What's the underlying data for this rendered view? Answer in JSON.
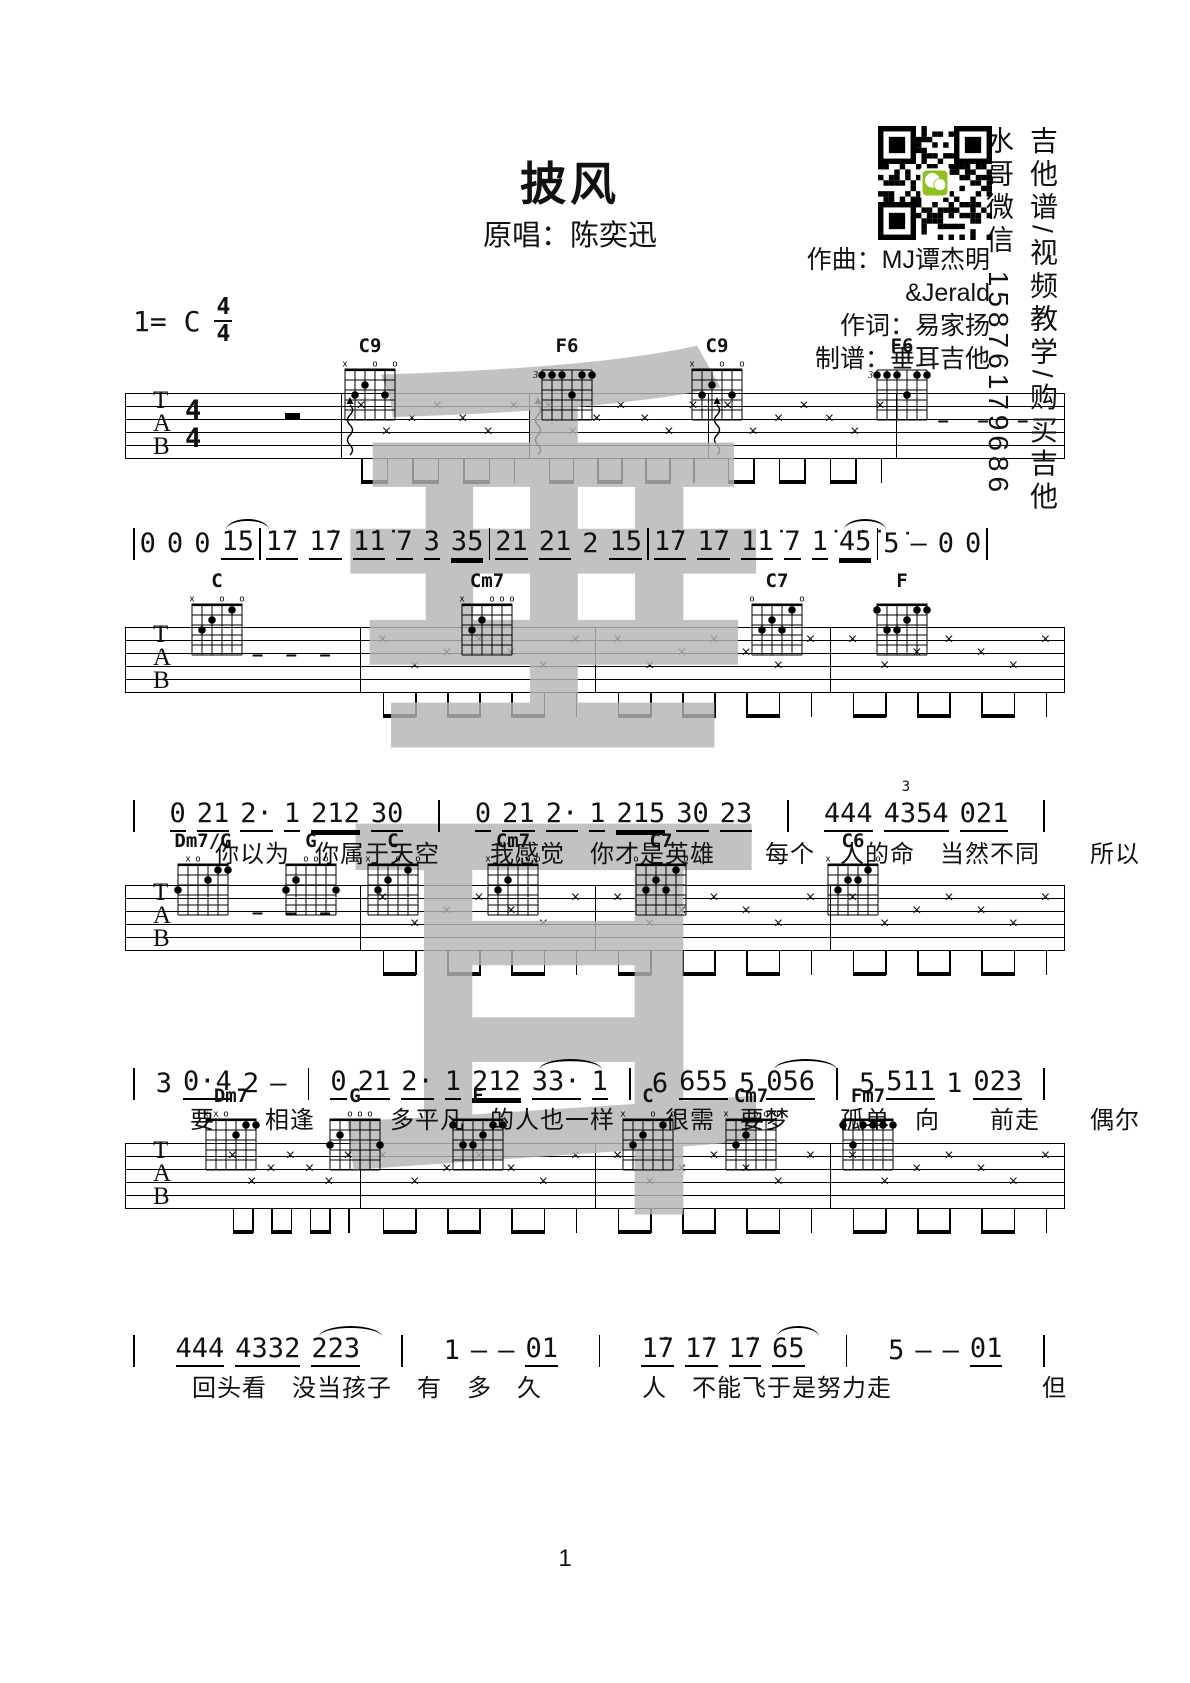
{
  "header": {
    "title": "披风",
    "subtitle": "原唱：陈奕迅",
    "credits": [
      "作曲：MJ谭杰明",
      "&Jerald",
      "作词：易家扬",
      "制谱：垂耳吉他"
    ],
    "side_text_1": "吉他谱/视频教学/购买吉他",
    "side_text_2": "水哥微信 15876179686",
    "key_label": "1= C",
    "time_signature": {
      "top": "4",
      "bottom": "4"
    }
  },
  "watermark": {
    "chars": [
      "垂",
      "耳"
    ],
    "color": "#b5b5b5"
  },
  "page": {
    "number": "1"
  },
  "staff_labels": [
    "T",
    "A",
    "B"
  ],
  "chord_shapes": {
    "C9": {
      "marks": [
        "x",
        "",
        "",
        "o",
        "",
        "o"
      ],
      "dots": [
        [
          5,
          3
        ],
        [
          4,
          2
        ],
        [
          2,
          3
        ]
      ]
    },
    "F6": {
      "base": "3",
      "dots": [
        [
          6,
          1
        ],
        [
          5,
          1
        ],
        [
          4,
          1
        ],
        [
          2,
          1
        ],
        [
          1,
          1
        ],
        [
          3,
          3
        ]
      ]
    },
    "C": {
      "marks": [
        "x",
        "",
        "",
        "o",
        "",
        "o"
      ],
      "dots": [
        [
          5,
          3
        ],
        [
          4,
          2
        ],
        [
          2,
          1
        ]
      ]
    },
    "Cm7": {
      "marks": [
        "x",
        "",
        "",
        "o",
        "o",
        "o"
      ],
      "dots": [
        [
          5,
          3
        ],
        [
          4,
          2
        ]
      ]
    },
    "C7": {
      "marks": [
        "o",
        "",
        "",
        "",
        "",
        "o"
      ],
      "dots": [
        [
          5,
          3
        ],
        [
          4,
          2
        ],
        [
          3,
          3
        ],
        [
          2,
          1
        ]
      ]
    },
    "F": {
      "marks": [
        "",
        "",
        "",
        "",
        "",
        ""
      ],
      "dots": [
        [
          6,
          1
        ],
        [
          2,
          1
        ],
        [
          1,
          1
        ],
        [
          3,
          2
        ],
        [
          5,
          3
        ],
        [
          4,
          3
        ]
      ]
    },
    "Dm7/G": {
      "marks": [
        "",
        "x",
        "o",
        "",
        "",
        ""
      ],
      "dots": [
        [
          6,
          3
        ],
        [
          3,
          2
        ],
        [
          2,
          1
        ],
        [
          1,
          1
        ]
      ]
    },
    "G": {
      "marks": [
        "",
        "",
        "o",
        "o",
        "o",
        ""
      ],
      "dots": [
        [
          6,
          3
        ],
        [
          5,
          2
        ],
        [
          1,
          3
        ]
      ]
    },
    "C6": {
      "marks": [
        "x",
        "",
        "",
        "",
        "",
        "o"
      ],
      "dots": [
        [
          5,
          3
        ],
        [
          4,
          2
        ],
        [
          3,
          2
        ],
        [
          2,
          1
        ]
      ]
    },
    "Dm7": {
      "marks": [
        "x",
        "x",
        "o",
        "",
        "",
        ""
      ],
      "dots": [
        [
          3,
          2
        ],
        [
          2,
          1
        ],
        [
          1,
          1
        ]
      ]
    },
    "Fm7": {
      "marks": [
        "",
        "",
        "",
        "",
        "",
        ""
      ],
      "dots": [
        [
          6,
          1
        ],
        [
          5,
          3
        ],
        [
          4,
          1
        ],
        [
          3,
          1
        ],
        [
          2,
          1
        ],
        [
          1,
          1
        ]
      ]
    }
  },
  "systems": [
    {
      "chordY": 336,
      "chords": [
        {
          "name": "C9",
          "left": 335
        },
        {
          "name": "F6",
          "left": 532
        },
        {
          "name": "C9",
          "left": 682
        },
        {
          "name": "F6",
          "left": 867
        }
      ],
      "staff": {
        "top": 393,
        "left": 125,
        "width": 940,
        "timesig": true,
        "measures": [
          {
            "end": 0.23,
            "type": "rest"
          },
          {
            "end": 0.43,
            "type": "x",
            "arp": true
          },
          {
            "end": 0.62,
            "type": "x",
            "arp": true
          },
          {
            "end": 0.82,
            "type": "x",
            "arp": true
          },
          {
            "end": 1,
            "type": "dash"
          }
        ]
      },
      "melody": {
        "top": 528,
        "left": 133,
        "width": 855,
        "measures": [
          [
            {
              "t": "0"
            },
            {
              "t": "0"
            },
            {
              "t": "0"
            },
            {
              "t": "15",
              "u": 1,
              "tie": true
            }
          ],
          [
            {
              "t": "1̇7",
              "u": 1
            },
            {
              "t": "1̇7",
              "u": 1
            },
            {
              "t": "1̇1̇",
              "u": 1
            },
            {
              "t": "7",
              "u": 1
            },
            {
              "t": "3",
              "u": 1
            },
            {
              "t": "35",
              "u": 2
            }
          ],
          [
            {
              "t": "21",
              "u": 1
            },
            {
              "t": "21",
              "u": 1
            },
            {
              "t": "2"
            },
            {
              "t": "15",
              "u": 1
            }
          ],
          [
            {
              "t": "1̇7",
              "u": 1
            },
            {
              "t": "1̇7",
              "u": 1
            },
            {
              "t": "1̇1̇",
              "u": 1
            },
            {
              "t": "7",
              "u": 1
            },
            {
              "t": "1̇",
              "u": 1
            },
            {
              "t": "4̇5̇",
              "u": 2,
              "tie": true
            }
          ],
          [
            {
              "t": "5̇"
            },
            {
              "t": "—"
            },
            {
              "t": "0"
            },
            {
              "t": "0"
            }
          ]
        ]
      },
      "lyrics": null
    },
    {
      "chordY": 571,
      "chords": [
        {
          "name": "C",
          "left": 182
        },
        {
          "name": "Cm7",
          "left": 452
        },
        {
          "name": "C7",
          "left": 742
        },
        {
          "name": "F",
          "left": 867
        }
      ],
      "staff": {
        "top": 627,
        "left": 125,
        "width": 940,
        "timesig": false,
        "measures": [
          {
            "end": 0.25,
            "type": "dash"
          },
          {
            "end": 0.5,
            "type": "x"
          },
          {
            "end": 0.75,
            "type": "x"
          },
          {
            "end": 1,
            "type": "x"
          }
        ]
      },
      "melody": {
        "top": 800,
        "left": 133,
        "width": 912,
        "measures": [
          [
            {
              "t": "0",
              "u": 1
            },
            {
              "t": "21",
              "u": 1
            },
            {
              "t": "2·",
              "u": 1
            },
            {
              "t": "1",
              "u": 1
            },
            {
              "t": "212",
              "u": 2
            },
            {
              "t": "30",
              "u": 1
            }
          ],
          [
            {
              "t": "0",
              "u": 1
            },
            {
              "t": "21",
              "u": 1
            },
            {
              "t": "2·",
              "u": 1
            },
            {
              "t": "1",
              "u": 1
            },
            {
              "t": "215",
              "u": 2
            },
            {
              "t": "30",
              "u": 1
            },
            {
              "t": "23",
              "u": 1
            }
          ],
          [
            {
              "t": "444",
              "u": 1
            },
            {
              "t": "4354",
              "u": 1,
              "sup": "3"
            },
            {
              "t": "021",
              "u": 1
            }
          ]
        ]
      },
      "lyrics": {
        "top": 834,
        "left": 215,
        "text": "你以为　你属于天空　　我感觉　你才是英雄　　每个　人的命　当然不同　　所以"
      }
    },
    {
      "chordY": 831,
      "chords": [
        {
          "name": "Dm7/G",
          "left": 168
        },
        {
          "name": "G",
          "left": 276
        },
        {
          "name": "C",
          "left": 358
        },
        {
          "name": "Cm7",
          "left": 478
        },
        {
          "name": "C7",
          "left": 626
        },
        {
          "name": "C6",
          "left": 818
        }
      ],
      "staff": {
        "top": 885,
        "left": 125,
        "width": 940,
        "timesig": false,
        "measures": [
          {
            "end": 0.25,
            "type": "dash"
          },
          {
            "end": 0.5,
            "type": "x"
          },
          {
            "end": 0.75,
            "type": "x"
          },
          {
            "end": 1,
            "type": "x"
          }
        ]
      },
      "melody": {
        "top": 1068,
        "left": 133,
        "width": 912,
        "measures": [
          [
            {
              "t": "3"
            },
            {
              "t": "0·4",
              "u": 1
            },
            {
              "t": "2"
            },
            {
              "t": "—"
            }
          ],
          [
            {
              "t": "0",
              "u": 1
            },
            {
              "t": "21",
              "u": 1
            },
            {
              "t": "2·",
              "u": 1
            },
            {
              "t": "1",
              "u": 1
            },
            {
              "t": "212",
              "u": 2
            },
            {
              "t": "33·",
              "u": 1,
              "tie": true
            },
            {
              "t": "1",
              "u": 1
            }
          ],
          [
            {
              "t": "6"
            },
            {
              "t": "655",
              "u": 1
            },
            {
              "t": "5"
            },
            {
              "t": "056",
              "u": 1,
              "tie": true
            }
          ],
          [
            {
              "t": "5"
            },
            {
              "t": "511",
              "u": 1
            },
            {
              "t": "1"
            },
            {
              "t": "023",
              "u": 1
            }
          ]
        ]
      },
      "lyrics": {
        "top": 1100,
        "left": 190,
        "text": "要　　相逢　　　多平凡　的人也一样　　很需　要梦　　孤单　向　　前走　　偶尔"
      }
    },
    {
      "chordY": 1086,
      "chords": [
        {
          "name": "Dm7",
          "left": 196
        },
        {
          "name": "G",
          "left": 320
        },
        {
          "name": "F",
          "left": 443
        },
        {
          "name": "C",
          "left": 613
        },
        {
          "name": "Cm7",
          "left": 716
        },
        {
          "name": "Fm7",
          "left": 833
        }
      ],
      "staff": {
        "top": 1143,
        "left": 125,
        "width": 940,
        "timesig": false,
        "measures": [
          {
            "end": 0.25,
            "type": "x"
          },
          {
            "end": 0.5,
            "type": "x"
          },
          {
            "end": 0.75,
            "type": "x"
          },
          {
            "end": 1,
            "type": "x"
          }
        ]
      },
      "melody": {
        "top": 1335,
        "left": 133,
        "width": 912,
        "measures": [
          [
            {
              "t": "444",
              "u": 1
            },
            {
              "t": "4332",
              "u": 1
            },
            {
              "t": "223",
              "u": 1,
              "tie": true
            }
          ],
          [
            {
              "t": "1"
            },
            {
              "t": "—"
            },
            {
              "t": "—"
            },
            {
              "t": "01",
              "u": 1
            }
          ],
          [
            {
              "t": "1̇7",
              "u": 1
            },
            {
              "t": "1̇7",
              "u": 1
            },
            {
              "t": "1̇7",
              "u": 1
            },
            {
              "t": "65",
              "u": 1,
              "tie": true
            }
          ],
          [
            {
              "t": "5"
            },
            {
              "t": "—"
            },
            {
              "t": "—"
            },
            {
              "t": "01",
              "u": 1
            }
          ]
        ]
      },
      "lyrics": {
        "top": 1368,
        "left": 192,
        "text": "回头看　没当孩子　有　多　久　　　　人　不能飞于是努力走　　　　　　但"
      }
    }
  ]
}
